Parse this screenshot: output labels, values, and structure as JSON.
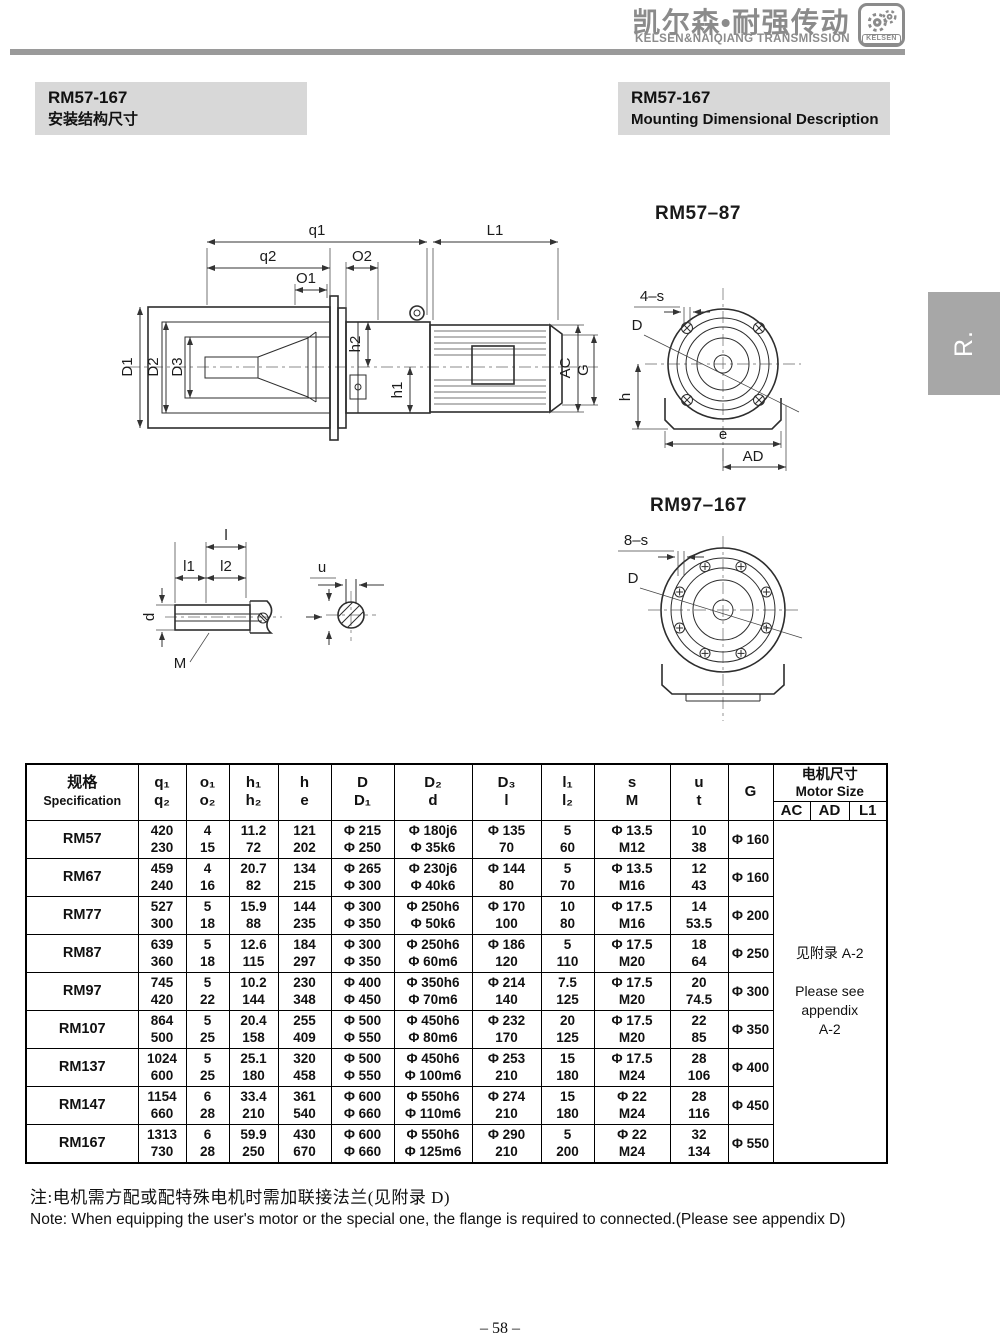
{
  "header": {
    "brand_cn": "凯尔森•耐强传动",
    "brand_en": "KELSEN&NAIQIANG TRANSMISSION",
    "logo_text": "KELSEN"
  },
  "titles": {
    "left": {
      "model": "RM57-167",
      "subtitle": "安装结构尺寸"
    },
    "right": {
      "model": "RM57-167",
      "subtitle": "Mounting Dimensional Description"
    }
  },
  "side_tab": "R.",
  "figures": {
    "side_view": {
      "q1": "q1",
      "q2": "q2",
      "o1": "O1",
      "o2": "O2",
      "L1": "L1",
      "D1": "D1",
      "D2": "D2",
      "D3": "D3",
      "h1": "h1",
      "h2": "h2",
      "AC": "AC",
      "G": "G"
    },
    "flange4": {
      "title": "RM57–87",
      "s": "4–s",
      "D": "D",
      "h": "h",
      "e": "e",
      "AD": "AD"
    },
    "flange8": {
      "title": "RM97–167",
      "s": "8–s",
      "D": "D"
    },
    "shaft": {
      "l": "l",
      "l1": "l1",
      "l2": "l2",
      "d": "d",
      "M": "M",
      "u": "u"
    }
  },
  "table": {
    "header": {
      "spec_cn": "规格",
      "spec_en": "Specification",
      "dim_cols": [
        [
          "q₁",
          "q₂"
        ],
        [
          "o₁",
          "o₂"
        ],
        [
          "h₁",
          "h₂"
        ],
        [
          "h",
          "e"
        ],
        [
          "D",
          "D₁"
        ],
        [
          "D₂",
          "d"
        ],
        [
          "D₃",
          "l"
        ],
        [
          "l₁",
          "l₂"
        ],
        [
          "s",
          "M"
        ],
        [
          "u",
          "t"
        ]
      ],
      "g": "G",
      "motor_cn": "电机尺寸",
      "motor_en": "Motor Size",
      "motor_sub": [
        "AC",
        "AD",
        "L1"
      ]
    },
    "rows": [
      {
        "spec": "RM57",
        "cells": [
          [
            "420",
            "230"
          ],
          [
            "4",
            "15"
          ],
          [
            "11.2",
            "72"
          ],
          [
            "121",
            "202"
          ],
          [
            "Φ 215",
            "Φ 250"
          ],
          [
            "Φ 180j6",
            "Φ 35k6"
          ],
          [
            "Φ 135",
            "70"
          ],
          [
            "5",
            "60"
          ],
          [
            "Φ 13.5",
            "M12"
          ],
          [
            "10",
            "38"
          ]
        ],
        "g": "Φ 160"
      },
      {
        "spec": "RM67",
        "cells": [
          [
            "459",
            "240"
          ],
          [
            "4",
            "16"
          ],
          [
            "20.7",
            "82"
          ],
          [
            "134",
            "215"
          ],
          [
            "Φ 265",
            "Φ 300"
          ],
          [
            "Φ 230j6",
            "Φ 40k6"
          ],
          [
            "Φ 144",
            "80"
          ],
          [
            "5",
            "70"
          ],
          [
            "Φ 13.5",
            "M16"
          ],
          [
            "12",
            "43"
          ]
        ],
        "g": "Φ 160"
      },
      {
        "spec": "RM77",
        "cells": [
          [
            "527",
            "300"
          ],
          [
            "5",
            "18"
          ],
          [
            "15.9",
            "88"
          ],
          [
            "144",
            "235"
          ],
          [
            "Φ 300",
            "Φ 350"
          ],
          [
            "Φ 250h6",
            "Φ 50k6"
          ],
          [
            "Φ 170",
            "100"
          ],
          [
            "10",
            "80"
          ],
          [
            "Φ 17.5",
            "M16"
          ],
          [
            "14",
            "53.5"
          ]
        ],
        "g": "Φ 200"
      },
      {
        "spec": "RM87",
        "cells": [
          [
            "639",
            "360"
          ],
          [
            "5",
            "18"
          ],
          [
            "12.6",
            "115"
          ],
          [
            "184",
            "297"
          ],
          [
            "Φ 300",
            "Φ 350"
          ],
          [
            "Φ 250h6",
            "Φ 60m6"
          ],
          [
            "Φ 186",
            "120"
          ],
          [
            "5",
            "110"
          ],
          [
            "Φ 17.5",
            "M20"
          ],
          [
            "18",
            "64"
          ]
        ],
        "g": "Φ 250"
      },
      {
        "spec": "RM97",
        "cells": [
          [
            "745",
            "420"
          ],
          [
            "5",
            "22"
          ],
          [
            "10.2",
            "144"
          ],
          [
            "230",
            "348"
          ],
          [
            "Φ 400",
            "Φ 450"
          ],
          [
            "Φ 350h6",
            "Φ 70m6"
          ],
          [
            "Φ 214",
            "140"
          ],
          [
            "7.5",
            "125"
          ],
          [
            "Φ 17.5",
            "M20"
          ],
          [
            "20",
            "74.5"
          ]
        ],
        "g": "Φ 300"
      },
      {
        "spec": "RM107",
        "cells": [
          [
            "864",
            "500"
          ],
          [
            "5",
            "25"
          ],
          [
            "20.4",
            "158"
          ],
          [
            "255",
            "409"
          ],
          [
            "Φ 500",
            "Φ 550"
          ],
          [
            "Φ 450h6",
            "Φ 80m6"
          ],
          [
            "Φ 232",
            "170"
          ],
          [
            "20",
            "125"
          ],
          [
            "Φ 17.5",
            "M20"
          ],
          [
            "22",
            "85"
          ]
        ],
        "g": "Φ 350"
      },
      {
        "spec": "RM137",
        "cells": [
          [
            "1024",
            "600"
          ],
          [
            "5",
            "25"
          ],
          [
            "25.1",
            "180"
          ],
          [
            "320",
            "458"
          ],
          [
            "Φ 500",
            "Φ 550"
          ],
          [
            "Φ 450h6",
            "Φ 100m6"
          ],
          [
            "Φ 253",
            "210"
          ],
          [
            "15",
            "180"
          ],
          [
            "Φ 17.5",
            "M24"
          ],
          [
            "28",
            "106"
          ]
        ],
        "g": "Φ 400"
      },
      {
        "spec": "RM147",
        "cells": [
          [
            "1154",
            "660"
          ],
          [
            "6",
            "28"
          ],
          [
            "33.4",
            "210"
          ],
          [
            "361",
            "540"
          ],
          [
            "Φ 600",
            "Φ 660"
          ],
          [
            "Φ 550h6",
            "Φ 110m6"
          ],
          [
            "Φ 274",
            "210"
          ],
          [
            "15",
            "180"
          ],
          [
            "Φ 22",
            "M24"
          ],
          [
            "28",
            "116"
          ]
        ],
        "g": "Φ 450"
      },
      {
        "spec": "RM167",
        "cells": [
          [
            "1313",
            "730"
          ],
          [
            "6",
            "28"
          ],
          [
            "59.9",
            "250"
          ],
          [
            "430",
            "670"
          ],
          [
            "Φ 600",
            "Φ 660"
          ],
          [
            "Φ 550h6",
            "Φ 125m6"
          ],
          [
            "Φ 290",
            "210"
          ],
          [
            "5",
            "200"
          ],
          [
            "Φ 22",
            "M24"
          ],
          [
            "32",
            "134"
          ]
        ],
        "g": "Φ 550"
      }
    ],
    "appendix": [
      "见附录 A-2",
      "",
      "Please see",
      "appendix",
      "A-2"
    ]
  },
  "notes": {
    "cn": "注:电机需方配或配特殊电机时需加联接法兰(见附录 D)",
    "en": "Note: When equipping the user's motor or the special one, the flange is required to connected.(Please see appendix D)"
  },
  "page_number": "– 58 –",
  "colors": {
    "brand_gray": "#8b8b8b",
    "title_bg": "#d8d8d8",
    "tab_bg": "#a7a7a7"
  }
}
